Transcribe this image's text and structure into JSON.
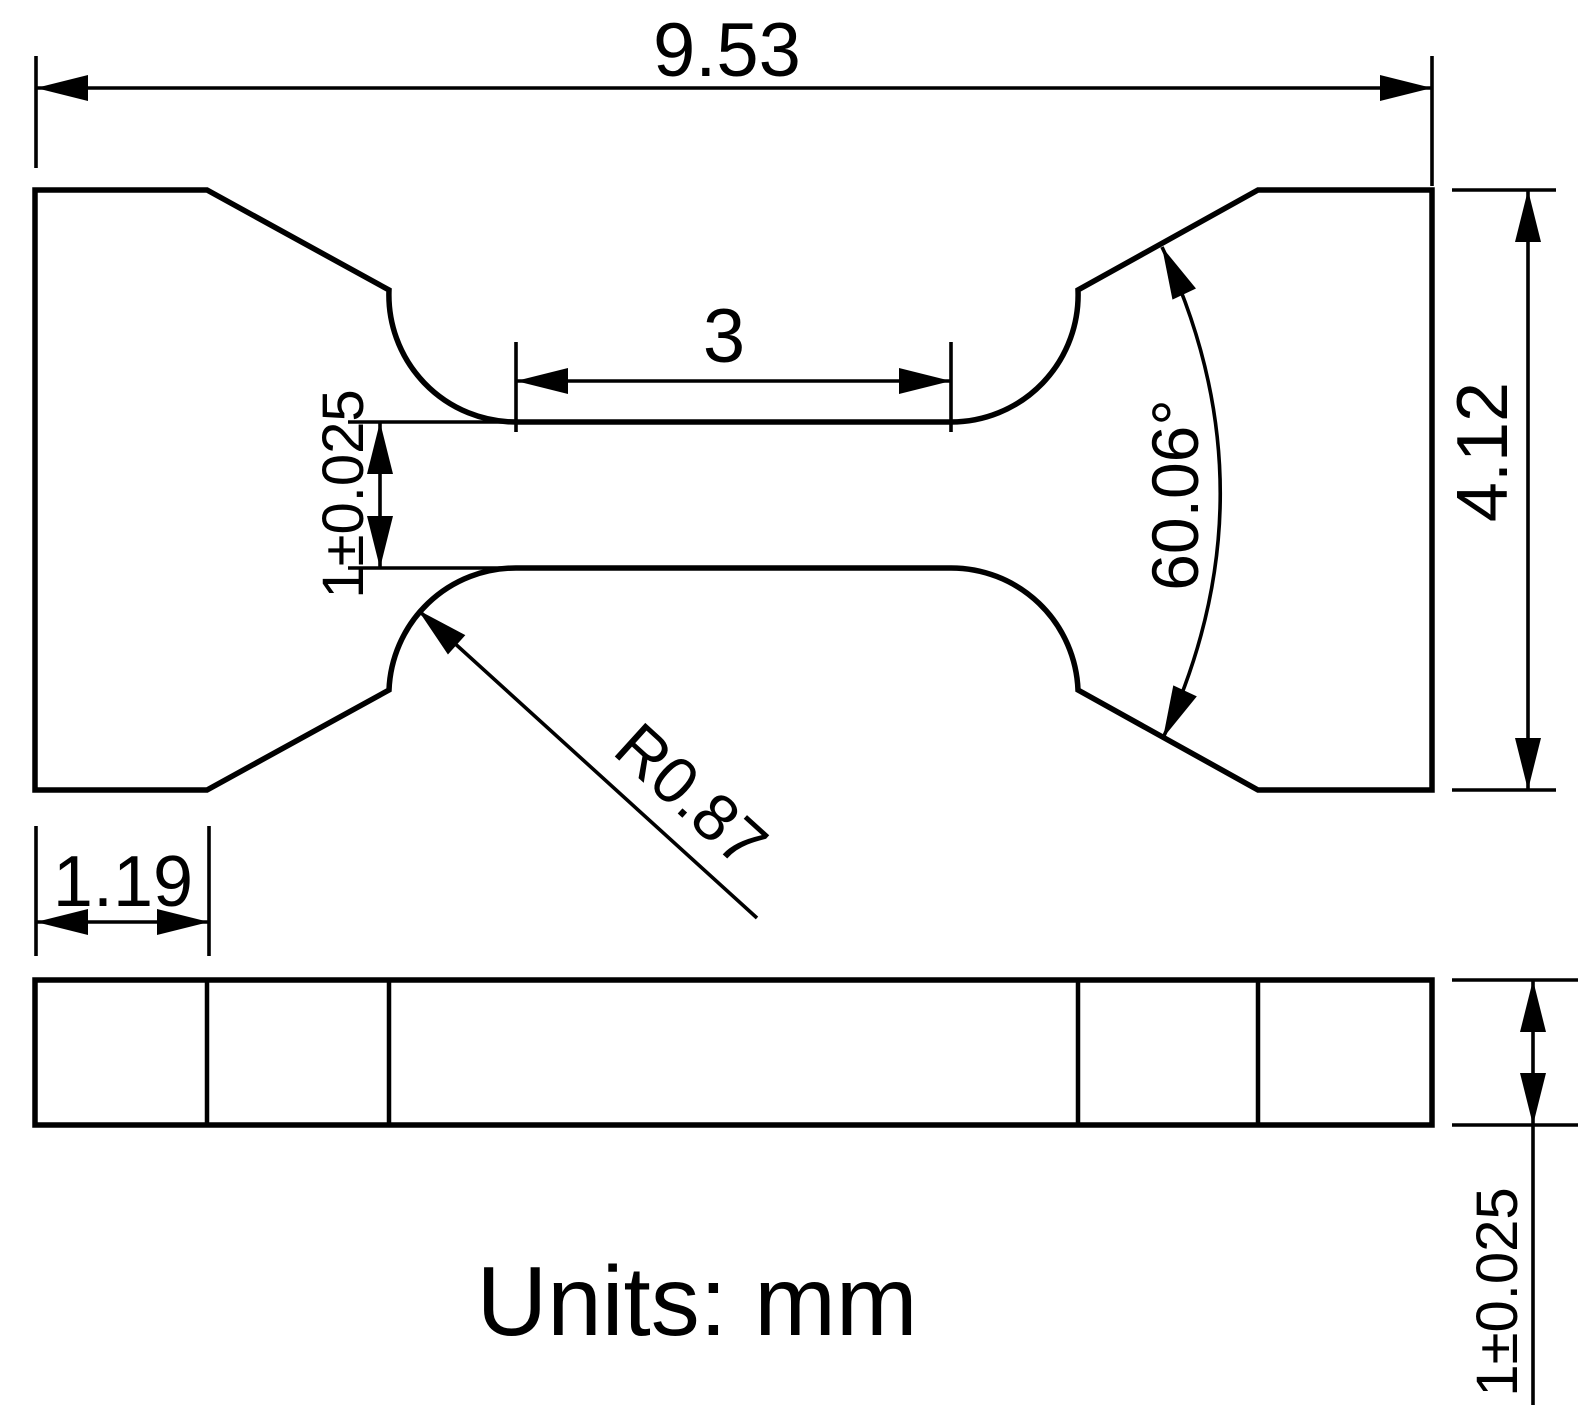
{
  "drawing": {
    "units_label": "Units: mm",
    "dimensions": {
      "overall_length": "9.53",
      "gauge_length": "3",
      "gauge_width_tol": "1±0.025",
      "overall_width": "4.12",
      "shoulder_angle": "60.06°",
      "fillet_radius": "R0.87",
      "grip_flat_length": "1.19",
      "thickness_tol": "1±0.025"
    },
    "colors": {
      "line": "#000000",
      "background": "#ffffff"
    }
  }
}
